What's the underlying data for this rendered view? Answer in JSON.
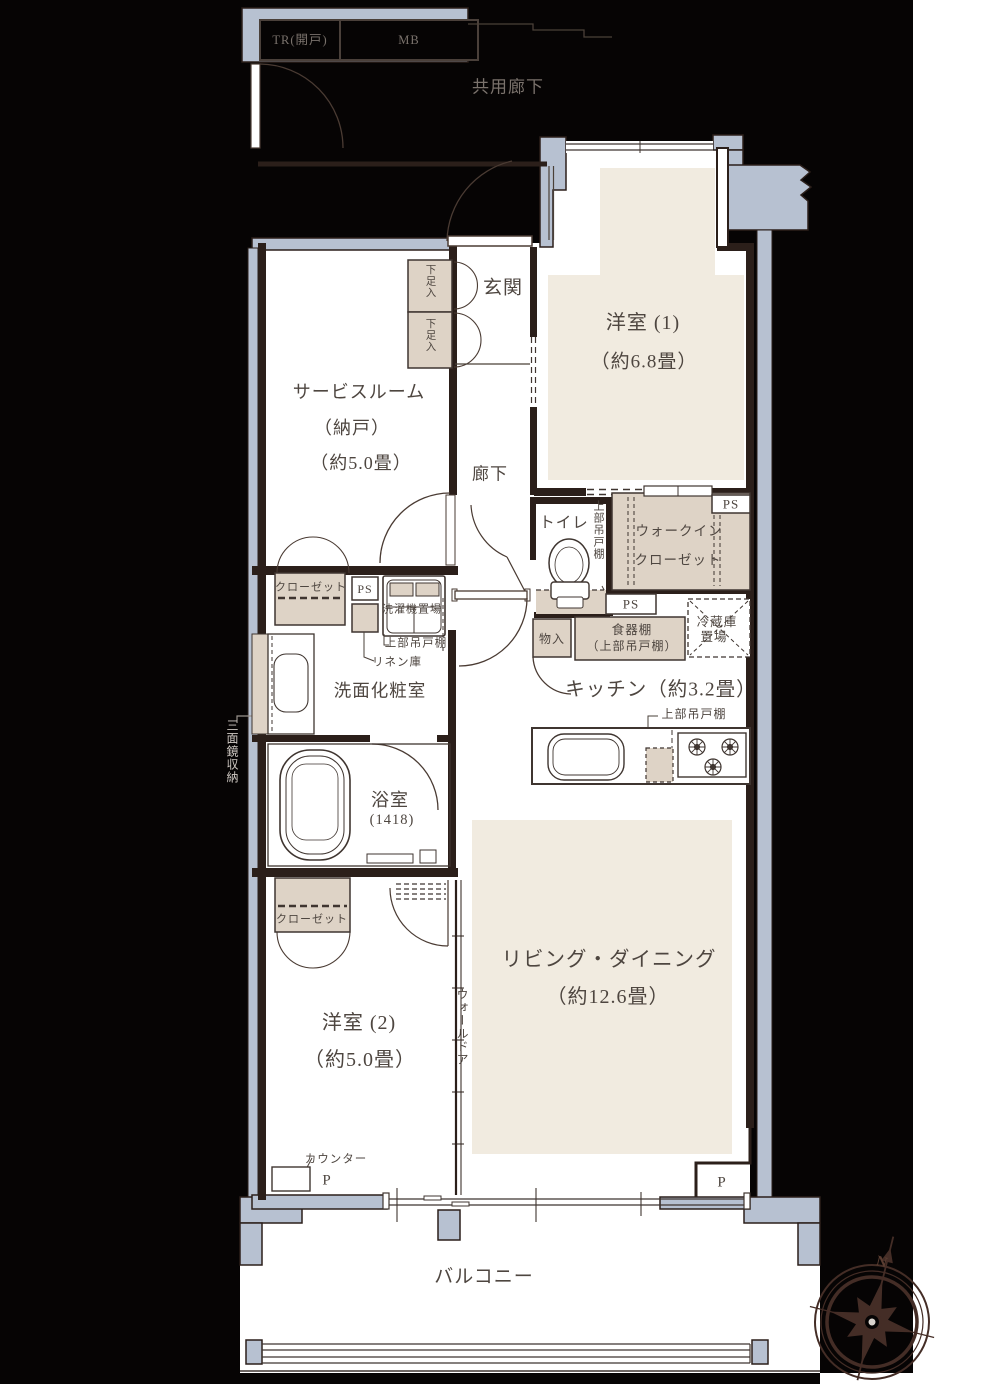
{
  "title": "マンション間取り図",
  "palette": {
    "background": "#060404",
    "wall": "#2b1f1a",
    "concrete": "#b7c1d1",
    "room_cream": "#f1ebe0",
    "storage_beige": "#ded3c6",
    "label_ink": "#4e4640",
    "label_muted": "#7a726c",
    "label_light": "#cfc9c3"
  },
  "exterior": {
    "trunk_label": "TR(開戸)",
    "meter_box_label": "MB",
    "common_corridor": "共用廊下"
  },
  "rooms": {
    "genkan": "玄関",
    "western1_name": "洋室 (1)",
    "western1_size": "（約6.8畳）",
    "service_name": "サービスルーム",
    "service_sub": "（納戸）",
    "service_size": "（約5.0畳）",
    "hall": "廊下",
    "toilet": "トイレ",
    "wic_line1": "ウォークイン",
    "wic_line2": "クローゼット",
    "kitchen": "キッチン（約3.2畳）",
    "washroom": "洗面化粧室",
    "bath_name": "浴室",
    "bath_size": "(1418)",
    "western2_name": "洋室 (2)",
    "western2_size": "（約5.0畳）",
    "living_name": "リビング・ダイニング",
    "living_size": "（約12.6畳）",
    "balcony": "バルコニー"
  },
  "fixtures": {
    "shoe_in": "下足入",
    "ps": "PS",
    "upper_cabinet": "上部吊戸棚",
    "closet": "クローゼット",
    "washer": "洗濯機置場",
    "linen": "リネン庫",
    "storage_small": "物入",
    "cupboard_line1": "食器棚",
    "cupboard_line2": "（上部吊戸棚）",
    "fridge_line1": "冷蔵庫",
    "fridge_line2": "置場",
    "mirror_cabinet": "三面鏡収納",
    "wall_door": "ウォールドア",
    "counter": "カウンター",
    "pillar": "P",
    "compass_north": "N"
  }
}
